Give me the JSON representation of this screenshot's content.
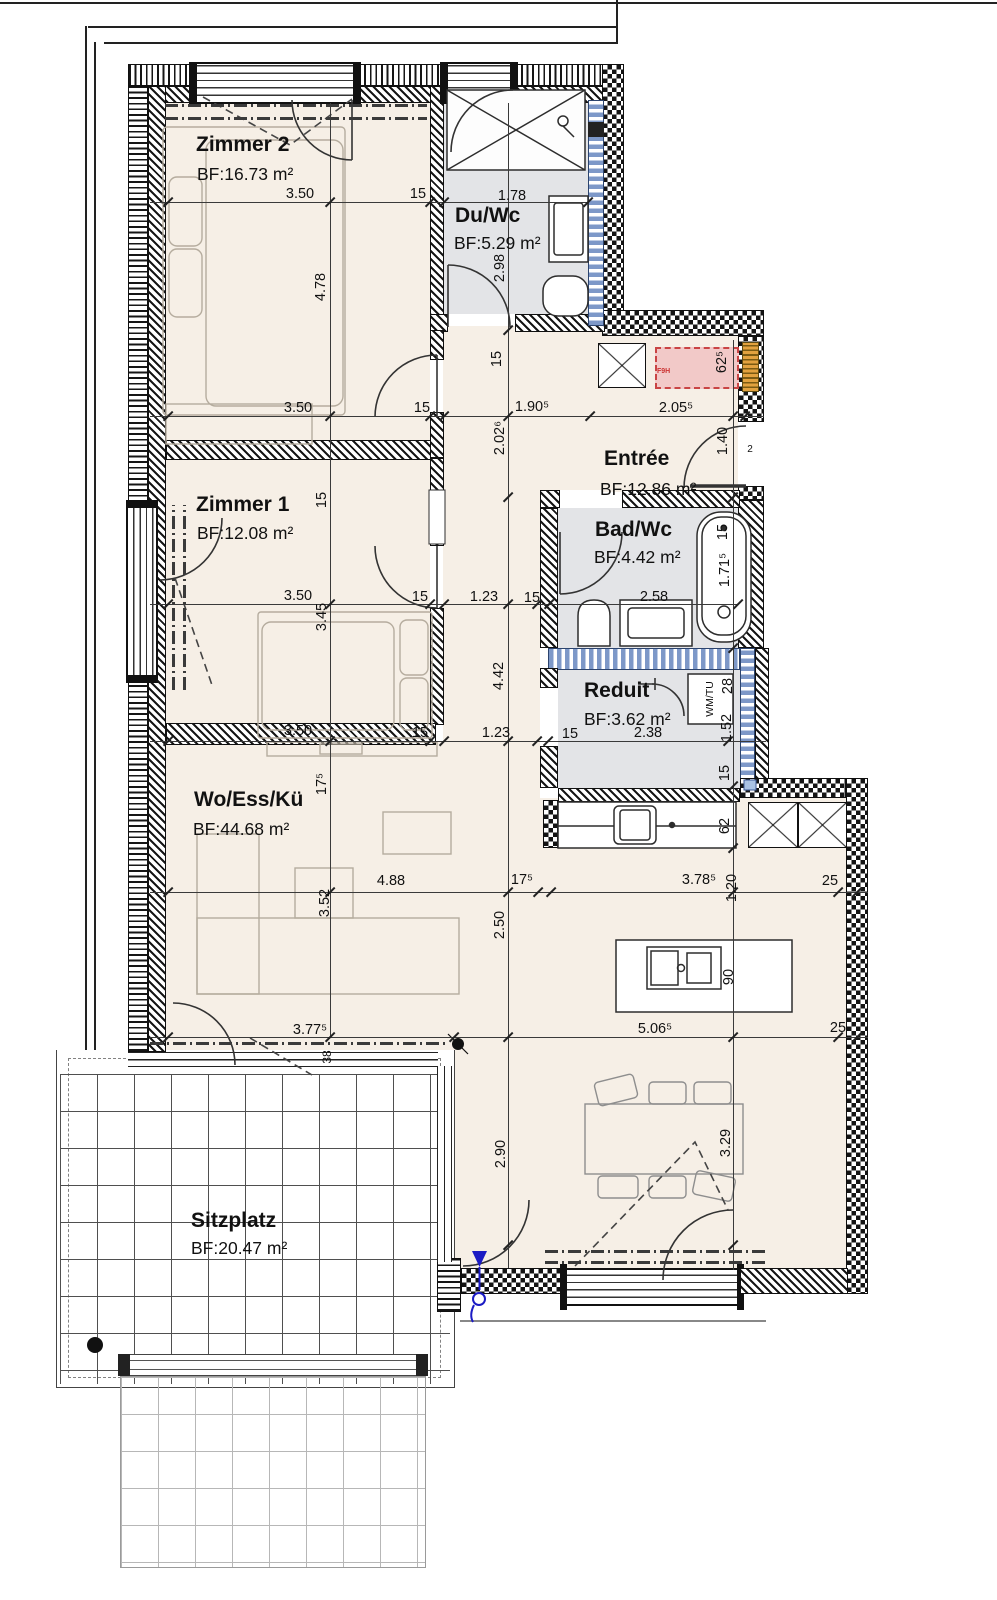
{
  "rooms": [
    {
      "id": "zimmer2",
      "name": "Zimmer 2",
      "area": "BF:16.73 m²"
    },
    {
      "id": "duwc",
      "name": "Du/Wc",
      "area": "BF:5.29 m²"
    },
    {
      "id": "entree",
      "name": "Entrée",
      "area": "BF:12.86 m²"
    },
    {
      "id": "zimmer1",
      "name": "Zimmer 1",
      "area": "BF:12.08 m²"
    },
    {
      "id": "badwc",
      "name": "Bad/Wc",
      "area": "BF:4.42 m²"
    },
    {
      "id": "reduit",
      "name": "Reduit",
      "area": "BF:3.62 m²"
    },
    {
      "id": "wo",
      "name": "Wo/Ess/Kü",
      "area": "BF:44.68 m²"
    },
    {
      "id": "sitzplatz",
      "name": "Sitzplatz",
      "area": "BF:20.47 m²"
    }
  ],
  "dims": {
    "h": [
      "3.50",
      "15",
      "1.78",
      "3.50",
      "15",
      "1.90⁵",
      "2.05⁵",
      "3.50",
      "15",
      "1.23",
      "15",
      "2.58",
      "3.50",
      "15",
      "1.23",
      "15",
      "2.38",
      "4.88",
      "17⁵",
      "3.78⁵",
      "25",
      "3.77⁵",
      "5.06⁵",
      "25"
    ],
    "v": [
      "4.78",
      "2.98",
      "15",
      "2.02⁶",
      "62⁵",
      "1.40",
      "15",
      "1.71⁵",
      "15",
      "3.45",
      "4.42",
      "28",
      "1.52",
      "15",
      "62",
      "17⁵",
      "3.52",
      "1.20",
      "2.50",
      "90",
      "38",
      "2.90",
      "3.29"
    ]
  },
  "tags": {
    "door_number": "2",
    "washer": "WM/TU",
    "fire_marker": "F9H"
  },
  "colors": {
    "floor": "#f6efe6",
    "wet_room": "#e3e4e7",
    "wall_line": "#111111",
    "insulation_blue": "#7d98c8",
    "marker_red": "#c94444",
    "marker_red_fill": "#f2c9c8",
    "wood_orange": "#e2a23f",
    "symbol_blue": "#1b1bc4"
  }
}
